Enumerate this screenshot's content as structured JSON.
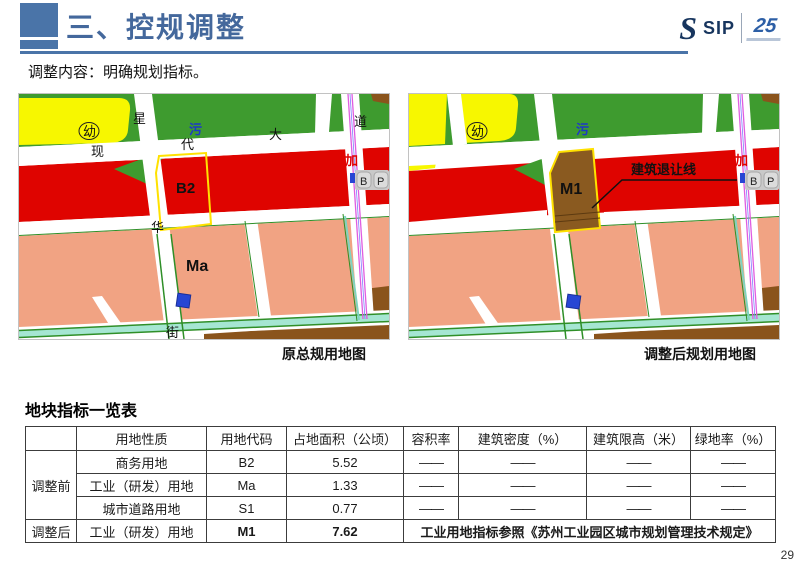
{
  "header": {
    "title": "三、控规调整",
    "logo": {
      "big_s": "S",
      "sip": "SIP",
      "anniversary": "25"
    }
  },
  "subtitle": "调整内容：明确规划指标。",
  "palette": {
    "accent_blue": "#4a74a8",
    "title_blue": "#44689c",
    "map_green": "#3e9b2f",
    "map_yellow": "#f7f700",
    "map_red": "#df0400",
    "map_salmon": "#f1a383",
    "map_brown": "#8a541c",
    "plot_outline_yellow": "#ffe100",
    "canal_teal": "#a5e6d2",
    "metro_magenta": "#e05ce0",
    "marker_blue": "#2746d4",
    "sewage_blue": "#1d39c8",
    "table_red": "#c00000"
  },
  "maps": {
    "left": {
      "caption": "原总规用地图",
      "labels": {
        "kindergarten": "幼",
        "road_xian": "现",
        "road_dai": "代",
        "road_da": "大",
        "road_dao": "道",
        "road_xing": "星",
        "road_hua": "华",
        "road_jie": "街",
        "sewage": "污",
        "gas": "加",
        "parking_b": "B",
        "parking_p": "P",
        "plot_code": "B2",
        "plot_ma": "Ma"
      }
    },
    "right": {
      "caption": "调整后规划用地图",
      "labels": {
        "kindergarten": "幼",
        "sewage": "污",
        "gas": "加",
        "parking_b": "B",
        "parking_p": "P",
        "plot_code": "M1",
        "setback_line": "建筑退让线"
      }
    }
  },
  "table": {
    "title": "地块指标一览表",
    "headers": [
      "",
      "用地性质",
      "用地代码",
      "占地面积（公顷）",
      "容积率",
      "建筑密度（%）",
      "建筑限高（米）",
      "绿地率（%）"
    ],
    "before_label": "调整前",
    "after_label": "调整后",
    "rows": [
      {
        "nature": "商务用地",
        "code": "B2",
        "area": "5.52",
        "far": "——",
        "density": "——",
        "height": "——",
        "green": "——"
      },
      {
        "nature": "工业（研发）用地",
        "code": "Ma",
        "area": "1.33",
        "far": "——",
        "density": "——",
        "height": "——",
        "green": "——"
      },
      {
        "nature": "城市道路用地",
        "code": "S1",
        "area": "0.77",
        "far": "——",
        "density": "——",
        "height": "——",
        "green": "——"
      }
    ],
    "after_row": {
      "nature": "工业（研发）用地",
      "code": "M1",
      "area": "7.62",
      "note": "工业用地指标参照《苏州工业园区城市规划管理技术规定》"
    }
  },
  "page_number": "29"
}
